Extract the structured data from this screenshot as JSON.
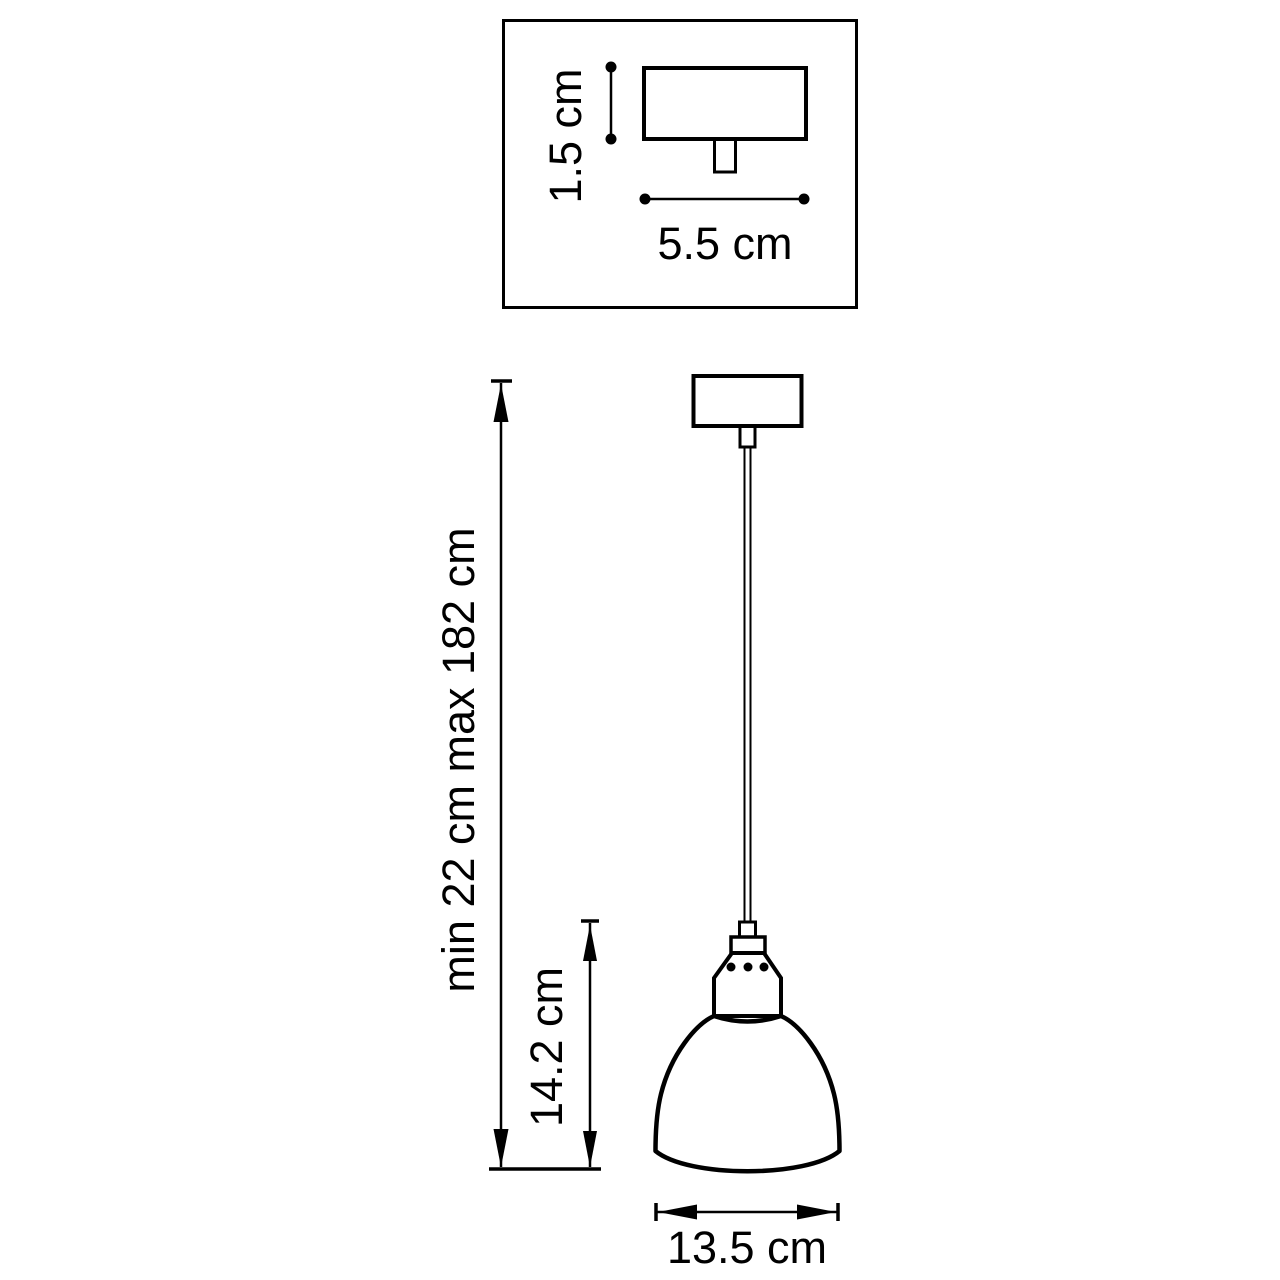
{
  "diagram": {
    "title_semantic": "pendant-lamp-dimension-drawing",
    "inset": {
      "height_label": "1.5 cm",
      "width_label": "5.5 cm"
    },
    "pendant": {
      "overall_height_label": "min 22 cm max 182 cm",
      "shade_height_label": "14.2 cm",
      "shade_width_label": "13.5 cm"
    },
    "colors": {
      "line": "#000000",
      "background": "#ffffff"
    }
  }
}
